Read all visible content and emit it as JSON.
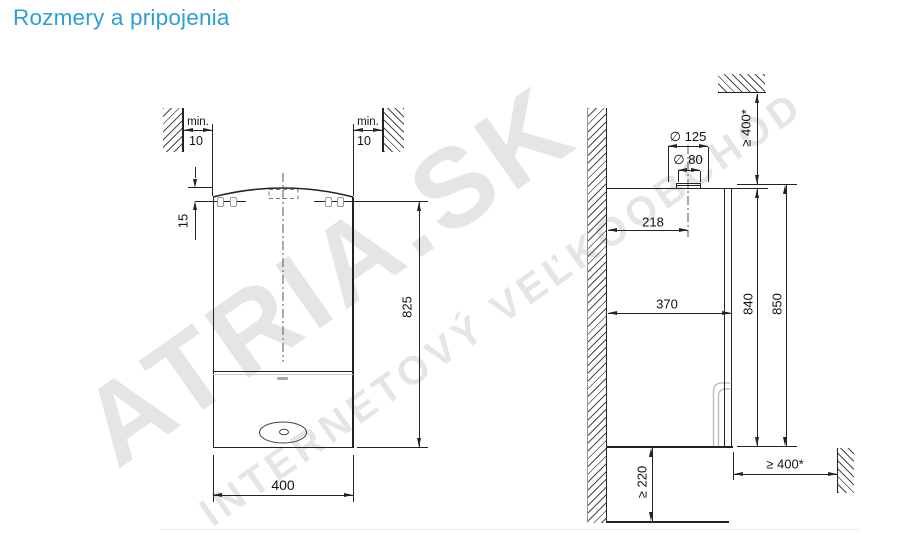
{
  "title": {
    "text": "Rozmery a pripojenia"
  },
  "watermark": {
    "line1": "ATRIA.SK",
    "line2": "INTERNETOVÝ VEĽKOOBCHOD"
  },
  "front_view": {
    "wall_left": {
      "label": "min.",
      "value": "10"
    },
    "wall_right": {
      "label": "min.",
      "value": "10"
    },
    "bracket_offset": "15",
    "height": "825",
    "width": "400"
  },
  "side_view": {
    "flue_outer_diameter": "∅ 125",
    "flue_inner_diameter": "∅ 80",
    "top_clearance": "≥ 400*",
    "flue_axis_from_wall": "218",
    "depth": "370",
    "body_height": "840",
    "total_height": "850",
    "bottom_clearance": "≥ 220",
    "front_clearance": "≥ 400*"
  },
  "colors": {
    "title": "#2e9ed6",
    "line": "#222222",
    "hatch": "#4a4a4a",
    "watermark": "rgba(0,0,0,0.10)"
  }
}
